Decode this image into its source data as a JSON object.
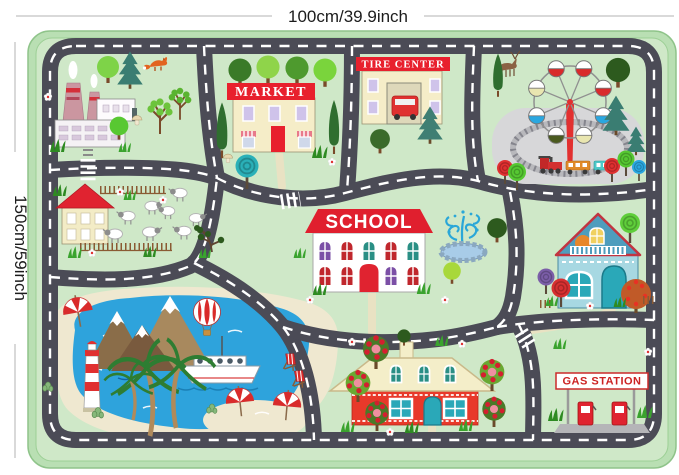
{
  "annotations": {
    "width_label": "100cm/39.9inch",
    "height_label": "150cm/59inch"
  },
  "mat": {
    "signs": {
      "market": "MARKET",
      "tire_center": "TIRE CENTER",
      "school": "SCHOOL",
      "gas_station": "GAS STATION"
    },
    "palette": {
      "border_green": "#b9dfb3",
      "ground_green": "#cfe8c8",
      "road_gray": "#4b4b56",
      "marking_white": "#ffffff",
      "sign_red": "#e8202d",
      "building_cream": "#f5edc8",
      "lake_blue": "#2ea3dc",
      "sand": "#efe8d0"
    },
    "features": [
      "factory with smoking chimneys",
      "forest with fox",
      "market",
      "tire center with car",
      "amusement park with ferris wheel, train and deer",
      "farm house with sheep and fences",
      "school with fountain",
      "lake with cruise ship and lighthouse",
      "snow-capped mountains",
      "hot air balloon",
      "beach with palm trees, umbrellas, deck chairs and cacti",
      "cottage with apple orchard",
      "blue cottage with orange tree",
      "gas station with two pumps",
      "road network with crosswalks and railroad crossings"
    ]
  }
}
